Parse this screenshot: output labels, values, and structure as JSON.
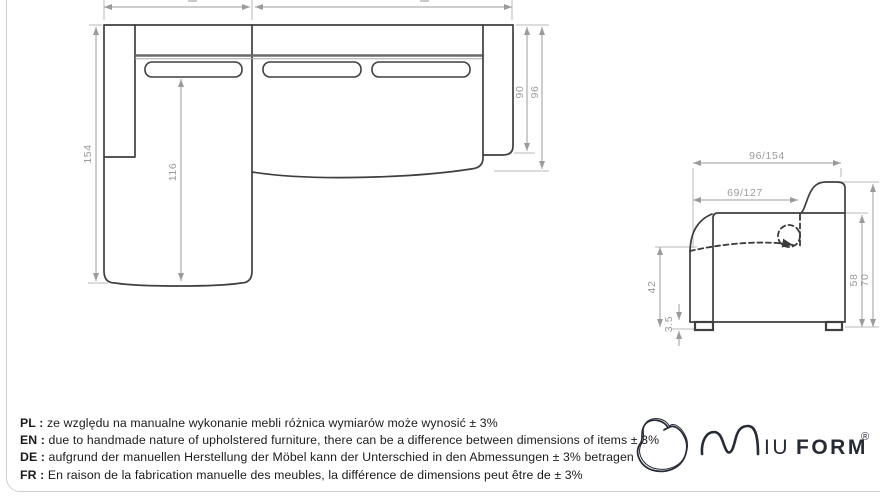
{
  "colors": {
    "outline": "#3f3f3f",
    "backrest": "#6a6a6a",
    "dim": "#9b9b9b",
    "dim-ext": "#b8b8b8",
    "frame": "#cfcfcf",
    "text": "#1b1b1b",
    "logo": "#272b35"
  },
  "top_view": {
    "dims": {
      "depth_total_left": "154",
      "chaise_inner": "116",
      "seat_right": "90",
      "depth_total_right": "96"
    }
  },
  "side_view": {
    "dims": {
      "width_total": "96/154",
      "width_inner": "69/127",
      "seat_height": "42",
      "foot_height": "3.5",
      "back_height": "58",
      "total_height": "70"
    }
  },
  "disclaimer": {
    "lines": [
      {
        "label": "PL :",
        "text": "ze względu na manualne wykonanie mebli różnica wymiarów może wynosić ± 3%"
      },
      {
        "label": "EN :",
        "text": "due to handmade nature of upholstered furniture, there can be a difference between dimensions of items ± 3%"
      },
      {
        "label": "DE :",
        "text": "aufgrund der manuellen Herstellung der Möbel kann der Unterschied in den Abmessungen ± 3% betragen"
      },
      {
        "label": "FR :",
        "text": "En raison de la fabrication manuelle des meubles, la différence de dimensions peut être de ± 3%"
      }
    ]
  },
  "logo": {
    "letters_regular": "IU",
    "letters_bold": "FORM",
    "registered": "®"
  }
}
